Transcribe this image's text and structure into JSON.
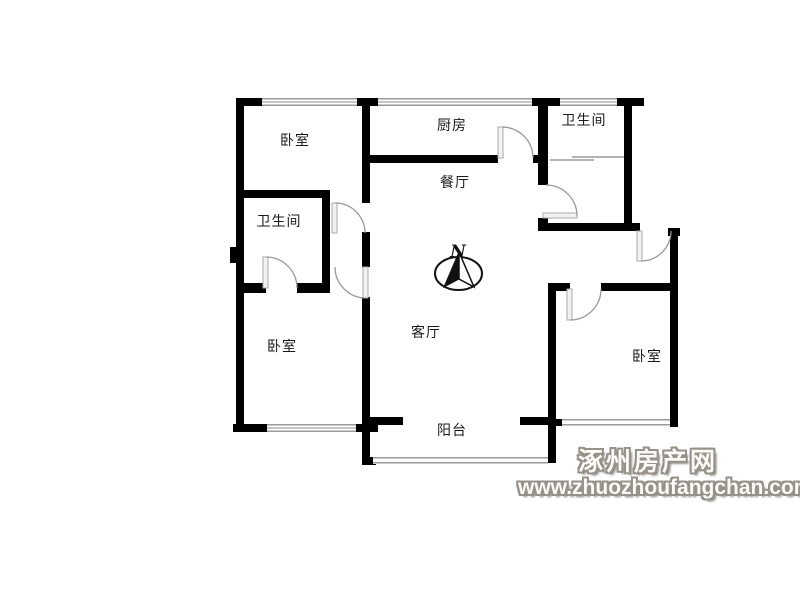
{
  "floorplan": {
    "rooms": [
      {
        "id": "bedroom-top-left",
        "label": "卧室"
      },
      {
        "id": "kitchen",
        "label": "厨房"
      },
      {
        "id": "bathroom-top-right",
        "label": "卫生间"
      },
      {
        "id": "dining-room",
        "label": "餐厅"
      },
      {
        "id": "bathroom-left",
        "label": "卫生间"
      },
      {
        "id": "bedroom-bottom-left",
        "label": "卧室"
      },
      {
        "id": "living-room",
        "label": "客厅"
      },
      {
        "id": "bedroom-bottom-right",
        "label": "卧室"
      },
      {
        "id": "balcony",
        "label": "阳台"
      }
    ],
    "compass": {
      "label": "N"
    },
    "colors": {
      "wall": "#000000",
      "window_line": "#9a9a9a",
      "door_arc": "#999999",
      "label_text": "#1a1a1a",
      "watermark_outline": "#969289"
    }
  },
  "watermark": {
    "site_name": "涿州房产网",
    "site_url": "www.zhuozhoufangchan.com"
  }
}
